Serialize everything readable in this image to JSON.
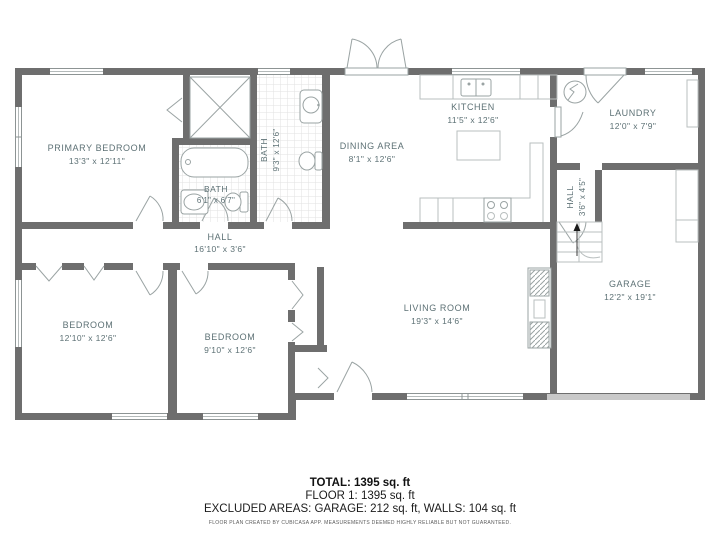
{
  "rooms": [
    {
      "name": "PRIMARY BEDROOM",
      "dims": "13'3\" x 12'11\""
    },
    {
      "name": "BATH",
      "dims": "6'1\" x 6'7\""
    },
    {
      "name": "BATH",
      "dims": "9'3\" x 12'6\""
    },
    {
      "name": "DINING AREA",
      "dims": "8'1\" x 12'6\""
    },
    {
      "name": "KITCHEN",
      "dims": "11'5\" x 12'6\""
    },
    {
      "name": "LAUNDRY",
      "dims": "12'0\" x 7'9\""
    },
    {
      "name": "HALL",
      "dims": "3'6\" x 4'5\""
    },
    {
      "name": "GARAGE",
      "dims": "12'2\" x 19'1\""
    },
    {
      "name": "HALL",
      "dims": "16'10\" x 3'6\""
    },
    {
      "name": "BEDROOM",
      "dims": "12'10\" x 12'6\""
    },
    {
      "name": "BEDROOM",
      "dims": "9'10\" x 12'6\""
    },
    {
      "name": "LIVING ROOM",
      "dims": "19'3\" x 14'6\""
    }
  ],
  "summary": {
    "total": "TOTAL: 1395 sq. ft",
    "floor": "FLOOR 1: 1395 sq. ft",
    "excluded": "EXCLUDED AREAS: GARAGE: 212 sq. ft, WALLS: 104 sq. ft",
    "disclaimer": "FLOOR PLAN CREATED BY CUBICASA APP. MEASUREMENTS DEEMED HIGHLY RELIABLE BUT NOT GUARANTEED."
  }
}
